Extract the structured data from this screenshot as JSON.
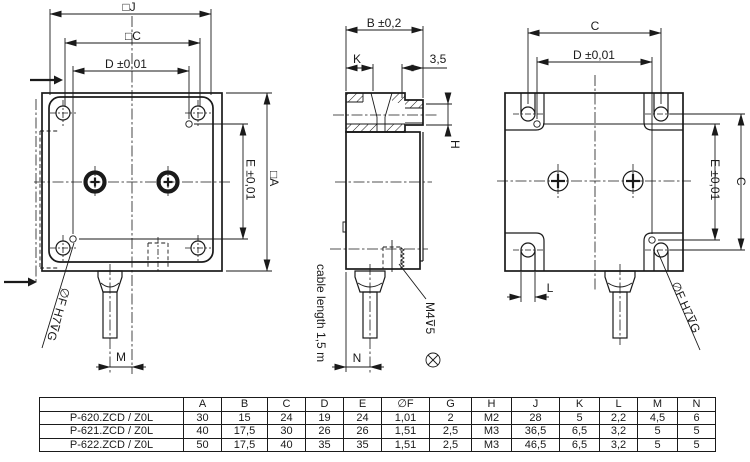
{
  "drawing": {
    "top_view": {
      "dim_j": "□J",
      "dim_c": "□C",
      "dim_d": "D ±0,01",
      "dim_e": "E ±0,01",
      "dim_a": "□A",
      "dim_m": "M",
      "hole_label": "∅F H7⊽G"
    },
    "side_view": {
      "dim_b": "B ±0,2",
      "dim_k": "K",
      "dim_35": "3,5",
      "dim_h": "H",
      "dim_n": "N",
      "cable_note": "cable length 1,5 m",
      "thread_label": "M4⊽5"
    },
    "bottom_view": {
      "dim_c_top": "C",
      "dim_d": "D ±0,01",
      "dim_e": "E ±0,01",
      "dim_c_right": "C",
      "dim_l": "L",
      "hole_label": "∅F H7⊽G"
    }
  },
  "table": {
    "headers": [
      "",
      "A",
      "B",
      "C",
      "D",
      "E",
      "∅F",
      "G",
      "H",
      "J",
      "K",
      "L",
      "M",
      "N"
    ],
    "rows": [
      {
        "name": "P-620.ZCD / Z0L",
        "values": [
          "30",
          "15",
          "24",
          "19",
          "24",
          "1,01",
          "2",
          "M2",
          "28",
          "5",
          "2,2",
          "4,5",
          "6"
        ]
      },
      {
        "name": "P-621.ZCD / Z0L",
        "values": [
          "40",
          "17,5",
          "30",
          "26",
          "26",
          "1,51",
          "2,5",
          "M3",
          "36,5",
          "6,5",
          "3,2",
          "5",
          "5"
        ]
      },
      {
        "name": "P-622.ZCD / Z0L",
        "values": [
          "50",
          "17,5",
          "40",
          "35",
          "35",
          "1,51",
          "2,5",
          "M3",
          "46,5",
          "6,5",
          "3,2",
          "5",
          "5"
        ]
      }
    ]
  },
  "colors": {
    "line": "#1a1a1a",
    "background": "#ffffff"
  }
}
